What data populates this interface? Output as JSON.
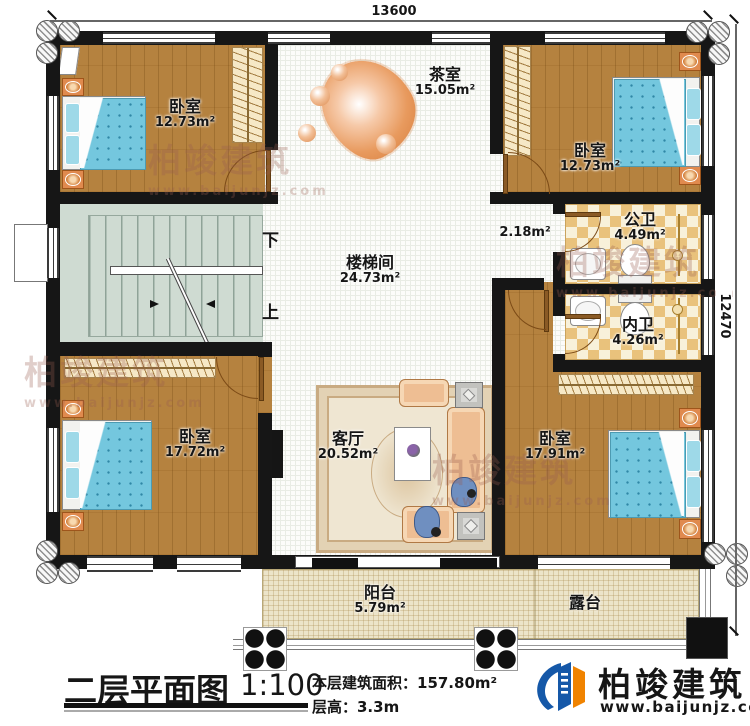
{
  "colors": {
    "wall": "#161616",
    "wood_floor": "#b5823f",
    "bed_blue": "#74c7de",
    "tile_tan": "#e9c27c",
    "deck_tan": "#ece4c9",
    "stair_green": "#cfdbd2",
    "brand_blue": "#1558a8",
    "brand_orange": "#f08300"
  },
  "dimensions": {
    "width_mm": "13600",
    "height_mm": "12470"
  },
  "rooms": {
    "bedroom_tl": {
      "name": "卧室",
      "area": "12.73m²"
    },
    "tea_room": {
      "name": "茶室",
      "area": "15.05m²"
    },
    "bedroom_tr": {
      "name": "卧室",
      "area": "12.73m²"
    },
    "stairwell": {
      "name": "楼梯间",
      "area": "24.73m²"
    },
    "hall_nook": {
      "area": "2.18m²"
    },
    "public_bath": {
      "name": "公卫",
      "area": "4.49m²"
    },
    "inner_bath": {
      "name": "内卫",
      "area": "4.26m²"
    },
    "bedroom_bl": {
      "name": "卧室",
      "area": "17.72m²"
    },
    "living_room": {
      "name": "客厅",
      "area": "20.52m²"
    },
    "bedroom_br": {
      "name": "卧室",
      "area": "17.91m²"
    },
    "balcony": {
      "name": "阳台",
      "area": "5.79m²"
    },
    "terrace": {
      "name": "露台"
    }
  },
  "stairs": {
    "down_label": "下",
    "up_label": "上"
  },
  "title_block": {
    "plan_title": "二层平面图",
    "scale": "1:100",
    "floor_area": "本层建筑面积：157.80m²",
    "floor_height": "层高：3.3m"
  },
  "brand": {
    "name": "柏竣建筑",
    "website": "www.baijunjz.com"
  },
  "watermark": {
    "name": "柏竣建筑",
    "website": "www.baijunjz.com"
  }
}
